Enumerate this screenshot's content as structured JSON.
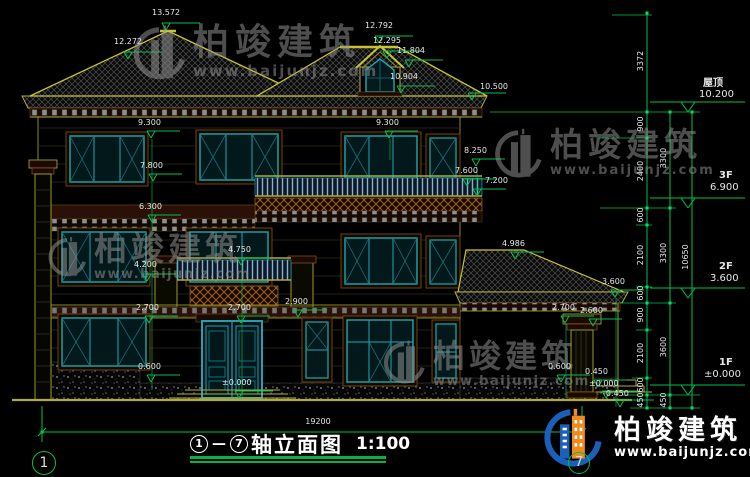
{
  "drawing_title": {
    "axis_start": "1",
    "separator": "—",
    "axis_end": "7",
    "name": "轴立面图",
    "scale": "1:100"
  },
  "axis_bubbles": {
    "left": "1",
    "right": "7"
  },
  "bottom_dimension": "19200",
  "levels": [
    {
      "label": "屋顶",
      "value": "10.200"
    },
    {
      "label": "3F",
      "value": "6.900"
    },
    {
      "label": "2F",
      "value": "3.600"
    },
    {
      "label": "1F",
      "value": "±0.000"
    }
  ],
  "annotations": [
    {
      "t": "13.572",
      "x": 152,
      "y": 9,
      "fx": 166,
      "fy": 30
    },
    {
      "t": "12.272",
      "x": 114,
      "y": 38,
      "fx": 128,
      "fy": 59
    },
    {
      "t": "12.792",
      "x": 365,
      "y": 22,
      "fx": 379,
      "fy": 43
    },
    {
      "t": "12.295",
      "x": 373,
      "y": 37,
      "fx": 387,
      "fy": 58
    },
    {
      "t": "11.804",
      "x": 397,
      "y": 47,
      "fx": 409,
      "fy": 67
    },
    {
      "t": "10.904",
      "x": 390,
      "y": 73,
      "fx": 401,
      "fy": 93
    },
    {
      "t": "10.500",
      "x": 480,
      "y": 83,
      "fx": 472,
      "fy": 100
    },
    {
      "t": "9.300",
      "x": 138,
      "y": 119,
      "fx": 151,
      "fy": 138
    },
    {
      "t": "9.300",
      "x": 376,
      "y": 119,
      "fx": 389,
      "fy": 138
    },
    {
      "t": "7.800",
      "x": 140,
      "y": 162,
      "fx": 153,
      "fy": 181
    },
    {
      "t": "8.250",
      "x": 464,
      "y": 147,
      "fx": 476,
      "fy": 166
    },
    {
      "t": "7.600",
      "x": 455,
      "y": 167,
      "fx": 467,
      "fy": 186
    },
    {
      "t": "7.200",
      "x": 485,
      "y": 177,
      "fx": 477,
      "fy": 196
    },
    {
      "t": "6.300",
      "x": 139,
      "y": 203,
      "fx": 152,
      "fy": 222
    },
    {
      "t": "4.986",
      "x": 502,
      "y": 240,
      "fx": 515,
      "fy": 259
    },
    {
      "t": "4.750",
      "x": 228,
      "y": 246,
      "fx": 241,
      "fy": 265
    },
    {
      "t": "4.200",
      "x": 134,
      "y": 261,
      "fx": 147,
      "fy": 281
    },
    {
      "t": "3.600",
      "x": 602,
      "y": 278,
      "fx": 615,
      "fy": 297
    },
    {
      "t": "2.900",
      "x": 285,
      "y": 298,
      "fx": 298,
      "fy": 317
    },
    {
      "t": "2.700",
      "x": 136,
      "y": 304,
      "fx": 149,
      "fy": 323
    },
    {
      "t": "2.700",
      "x": 228,
      "y": 304,
      "fx": 241,
      "fy": 323
    },
    {
      "t": "2.700",
      "x": 552,
      "y": 304,
      "fx": 565,
      "fy": 323
    },
    {
      "t": "2.600",
      "x": 580,
      "y": 307,
      "fx": 593,
      "fy": 326
    },
    {
      "t": "0.600",
      "x": 138,
      "y": 363,
      "fx": 151,
      "fy": 382
    },
    {
      "t": "0.600",
      "x": 548,
      "y": 363,
      "fx": 561,
      "fy": 382
    },
    {
      "t": "0.450",
      "x": 585,
      "y": 368,
      "fx": 598,
      "fy": 387
    },
    {
      "t": "±0.000",
      "x": 222,
      "y": 379,
      "fx": 239,
      "fy": 398
    },
    {
      "t": "±0.000",
      "x": 589,
      "y": 380,
      "fx": 606,
      "fy": 398
    },
    {
      "t": "-0.450",
      "x": 603,
      "y": 390,
      "fx": 620,
      "fy": 407
    }
  ],
  "chain_dims": [
    {
      "t": "3372",
      "x": 641,
      "y": 62
    },
    {
      "t": "900",
      "x": 641,
      "y": 125
    },
    {
      "t": "2400",
      "x": 641,
      "y": 172
    },
    {
      "t": "600",
      "x": 641,
      "y": 216
    },
    {
      "t": "2100",
      "x": 641,
      "y": 256
    },
    {
      "t": "600",
      "x": 641,
      "y": 294
    },
    {
      "t": "900",
      "x": 641,
      "y": 316
    },
    {
      "t": "2100",
      "x": 641,
      "y": 354
    },
    {
      "t": "600",
      "x": 641,
      "y": 386
    },
    {
      "t": "450",
      "x": 641,
      "y": 401
    },
    {
      "t": "3300",
      "x": 664,
      "y": 159
    },
    {
      "t": "3300",
      "x": 664,
      "y": 254
    },
    {
      "t": "3600",
      "x": 664,
      "y": 348
    },
    {
      "t": "450",
      "x": 664,
      "y": 401
    },
    {
      "t": "10650",
      "x": 686,
      "y": 258
    }
  ],
  "watermark": {
    "text": "柏竣建筑",
    "url": "www.baijunjz.com"
  },
  "brand": {
    "text": "柏竣建筑",
    "url": "www.baijunjz.com"
  },
  "colors": {
    "dim_green": "#00c050",
    "cad_yellow": "#a8a23c",
    "frame_cyan": "#1ea8b0",
    "band_brown": "#6a4416",
    "brand_blue": "#1a5fb8",
    "brand_orange": "#f08a1e"
  }
}
